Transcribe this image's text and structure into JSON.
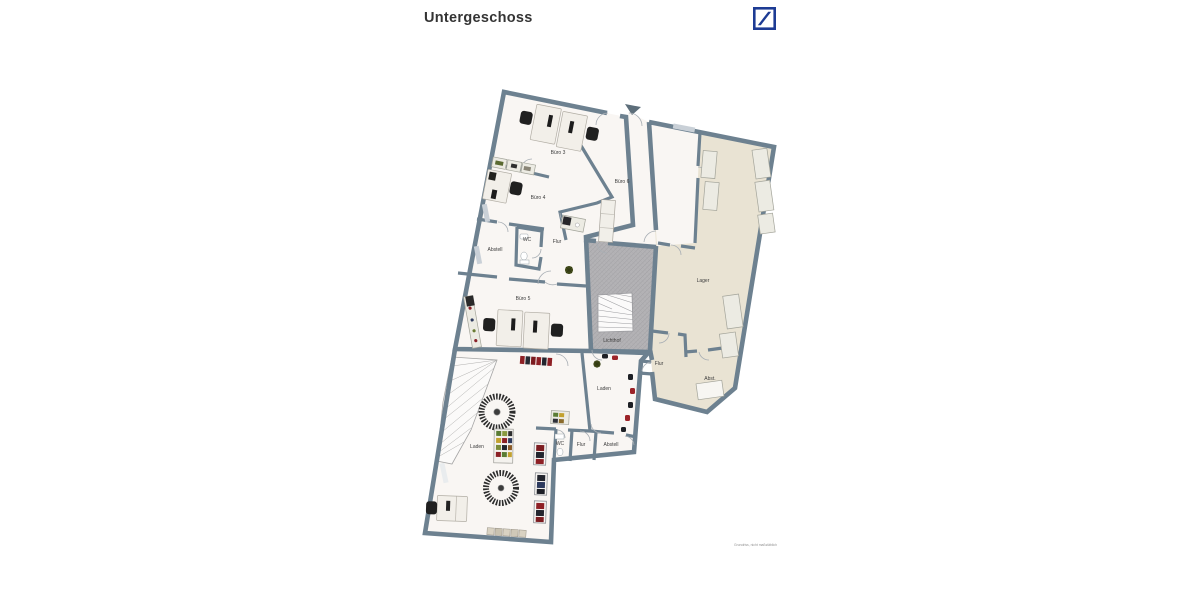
{
  "page": {
    "title": "Untergeschoss"
  },
  "logo": {
    "name": "deutsche-bank-logo",
    "primary_color": "#1d3b94"
  },
  "floorplan": {
    "caption": "Grundriss, nicht maßstäblich",
    "colors": {
      "wall": "#6d8190",
      "room": "#f9f6f3",
      "storage": "#e9e3d3",
      "lightwell": "#b3b2b5",
      "accent_red": "#8e2025",
      "accent_dark": "#202020"
    },
    "rooms": {
      "buero3": "Büro 3",
      "buero4": "Büro 4",
      "buero6": "Büro 6",
      "wc_upper": "WC",
      "flur_upper": "Flur",
      "abstell_upper": "Abstell",
      "buero5": "Büro 5",
      "lichthof": "Lichthof",
      "lager": "Lager",
      "flur_right": "Flur",
      "abst": "Abst.",
      "laden_left": "Laden",
      "laden_right": "Laden",
      "wc_lower": "WC",
      "flur_lower": "Flur",
      "abstell_lower": "Abstell"
    }
  }
}
